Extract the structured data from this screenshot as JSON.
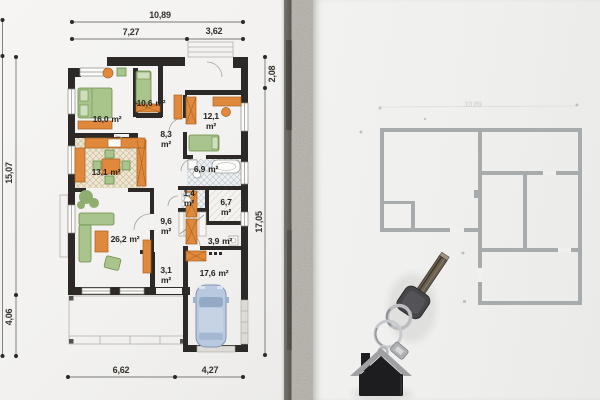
{
  "blueprint": {
    "dimensions": {
      "top_total": "10,89",
      "top_left": "7,27",
      "top_right": "3,62",
      "left_main": "15,07",
      "left_lower": "4,06",
      "right_upper": "2,08",
      "right_main": "17,05",
      "bottom_left": "6,62",
      "bottom_right": "4,27"
    },
    "rooms": [
      {
        "value": "16,0",
        "unit": "m²"
      },
      {
        "value": "10,6",
        "unit": "m²"
      },
      {
        "value": "12,1",
        "unit": "m²"
      },
      {
        "value": "8,3",
        "unit": "m²"
      },
      {
        "value": "13,1",
        "unit": "m²"
      },
      {
        "value": "6,9",
        "unit": "m²"
      },
      {
        "value": "1,4",
        "unit": "m²"
      },
      {
        "value": "6,7",
        "unit": "m²"
      },
      {
        "value": "9,6",
        "unit": "m²"
      },
      {
        "value": "3,9",
        "unit": "m²"
      },
      {
        "value": "26,2",
        "unit": "m²"
      },
      {
        "value": "3,1",
        "unit": "m²"
      },
      {
        "value": "17,6",
        "unit": "m²"
      }
    ]
  },
  "second_plan": {
    "faint_dimension": "10,89"
  },
  "objects": [
    {
      "name": "door-key"
    },
    {
      "name": "house-keychain"
    },
    {
      "name": "car-top-view"
    }
  ],
  "colors": {
    "wall_dark": "#2c2926",
    "furniture_orange": "#e0893c",
    "furniture_green": "#a9c48c",
    "car_blue": "#b9c9df",
    "secondary_plan_gray": "#a8abac",
    "paper_left": "#f4f3f1",
    "paper_right": "#f0f0ee",
    "concrete_strip": "#b5b2a8",
    "keychain_black": "#1d1d1f"
  }
}
